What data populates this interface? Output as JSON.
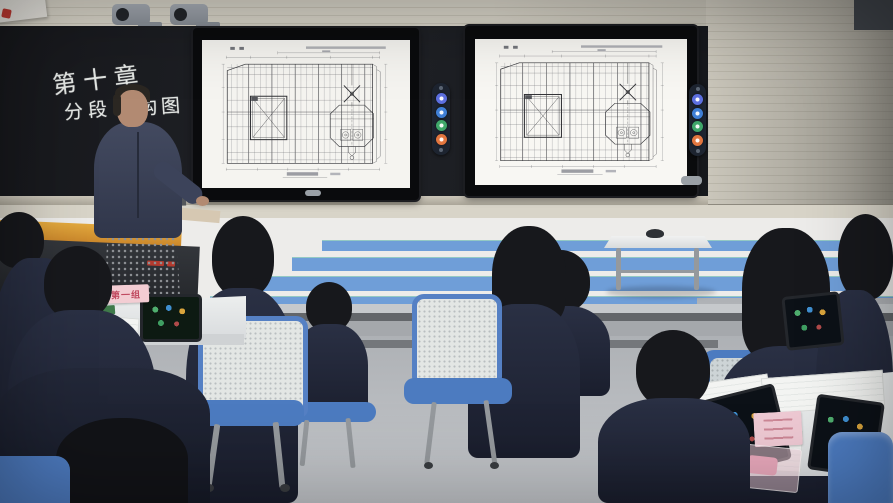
{
  "scene": {
    "type": "classroom-lecture-photo"
  },
  "board": {
    "chalk_line1": "第十章",
    "chalk_line2a": "分段",
    "chalk_line2b": "构图"
  },
  "screens": {
    "count": 2,
    "content": "ship-deck-structural-plan-slide",
    "toolbar_buttons": [
      {
        "name": "tool-blue",
        "color": "#5c6fe0"
      },
      {
        "name": "tool-lightblue",
        "color": "#3f7fd6"
      },
      {
        "name": "tool-green",
        "color": "#3fa76a"
      },
      {
        "name": "tool-orange",
        "color": "#e2763f"
      }
    ]
  },
  "cards": {
    "group_label": "第一组"
  },
  "palette": {
    "wall_stripe_blue": "#6f9ed8",
    "chair_blue": "#4f7ec4",
    "uniform_navy": "#20263a",
    "desk_orange": "#d08f2e",
    "card_pink": "#f3cdd3",
    "board_black": "#1a1c20"
  }
}
